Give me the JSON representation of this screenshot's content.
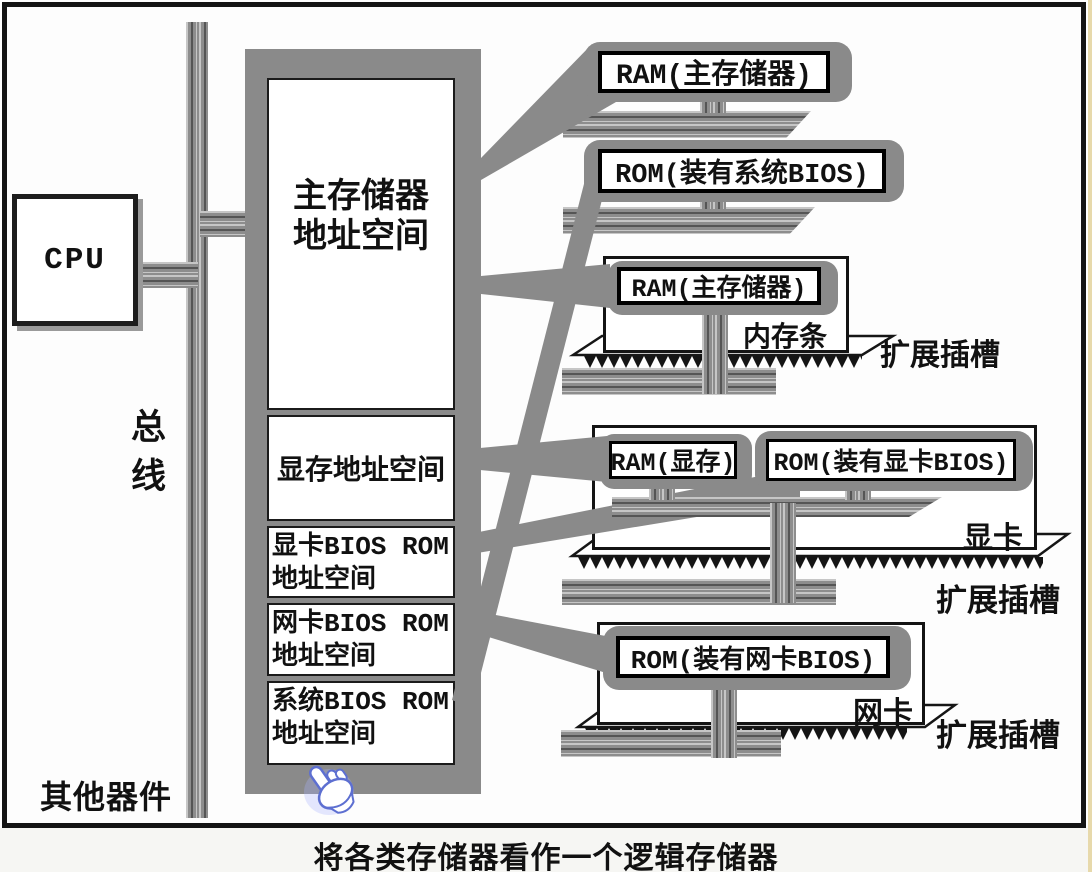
{
  "diagram": {
    "cpu": {
      "label": "CPU"
    },
    "bus": {
      "label": "总线"
    },
    "other_devices": {
      "label": "其他器件"
    },
    "caption": "将各类存储器看作一个逻辑存储器",
    "address_space": {
      "sections": [
        {
          "label": "主存储器\n地址空间"
        },
        {
          "label": "显存地址空间"
        },
        {
          "label": "显卡BIOS ROM\n地址空间"
        },
        {
          "label": "网卡BIOS ROM\n地址空间"
        },
        {
          "label": "系统BIOS ROM\n地址空间"
        }
      ]
    },
    "callouts": {
      "ram_main": {
        "label": "RAM(主存储器)"
      },
      "rom_system_bios": {
        "label": "ROM(装有系统BIOS)"
      }
    },
    "memory_module": {
      "chip": "RAM(主存储器)",
      "name": "内存条",
      "slot": "扩展插槽"
    },
    "video_card": {
      "ram": "RAM(显存)",
      "rom": "ROM(装有显卡BIOS)",
      "name": "显卡",
      "slot": "扩展插槽"
    },
    "network_card": {
      "rom": "ROM(装有网卡BIOS)",
      "name": "网卡",
      "slot": "扩展插槽"
    },
    "colors": {
      "gray": "#8a8a8a",
      "cursor_blue": "#5d6fd1"
    }
  }
}
